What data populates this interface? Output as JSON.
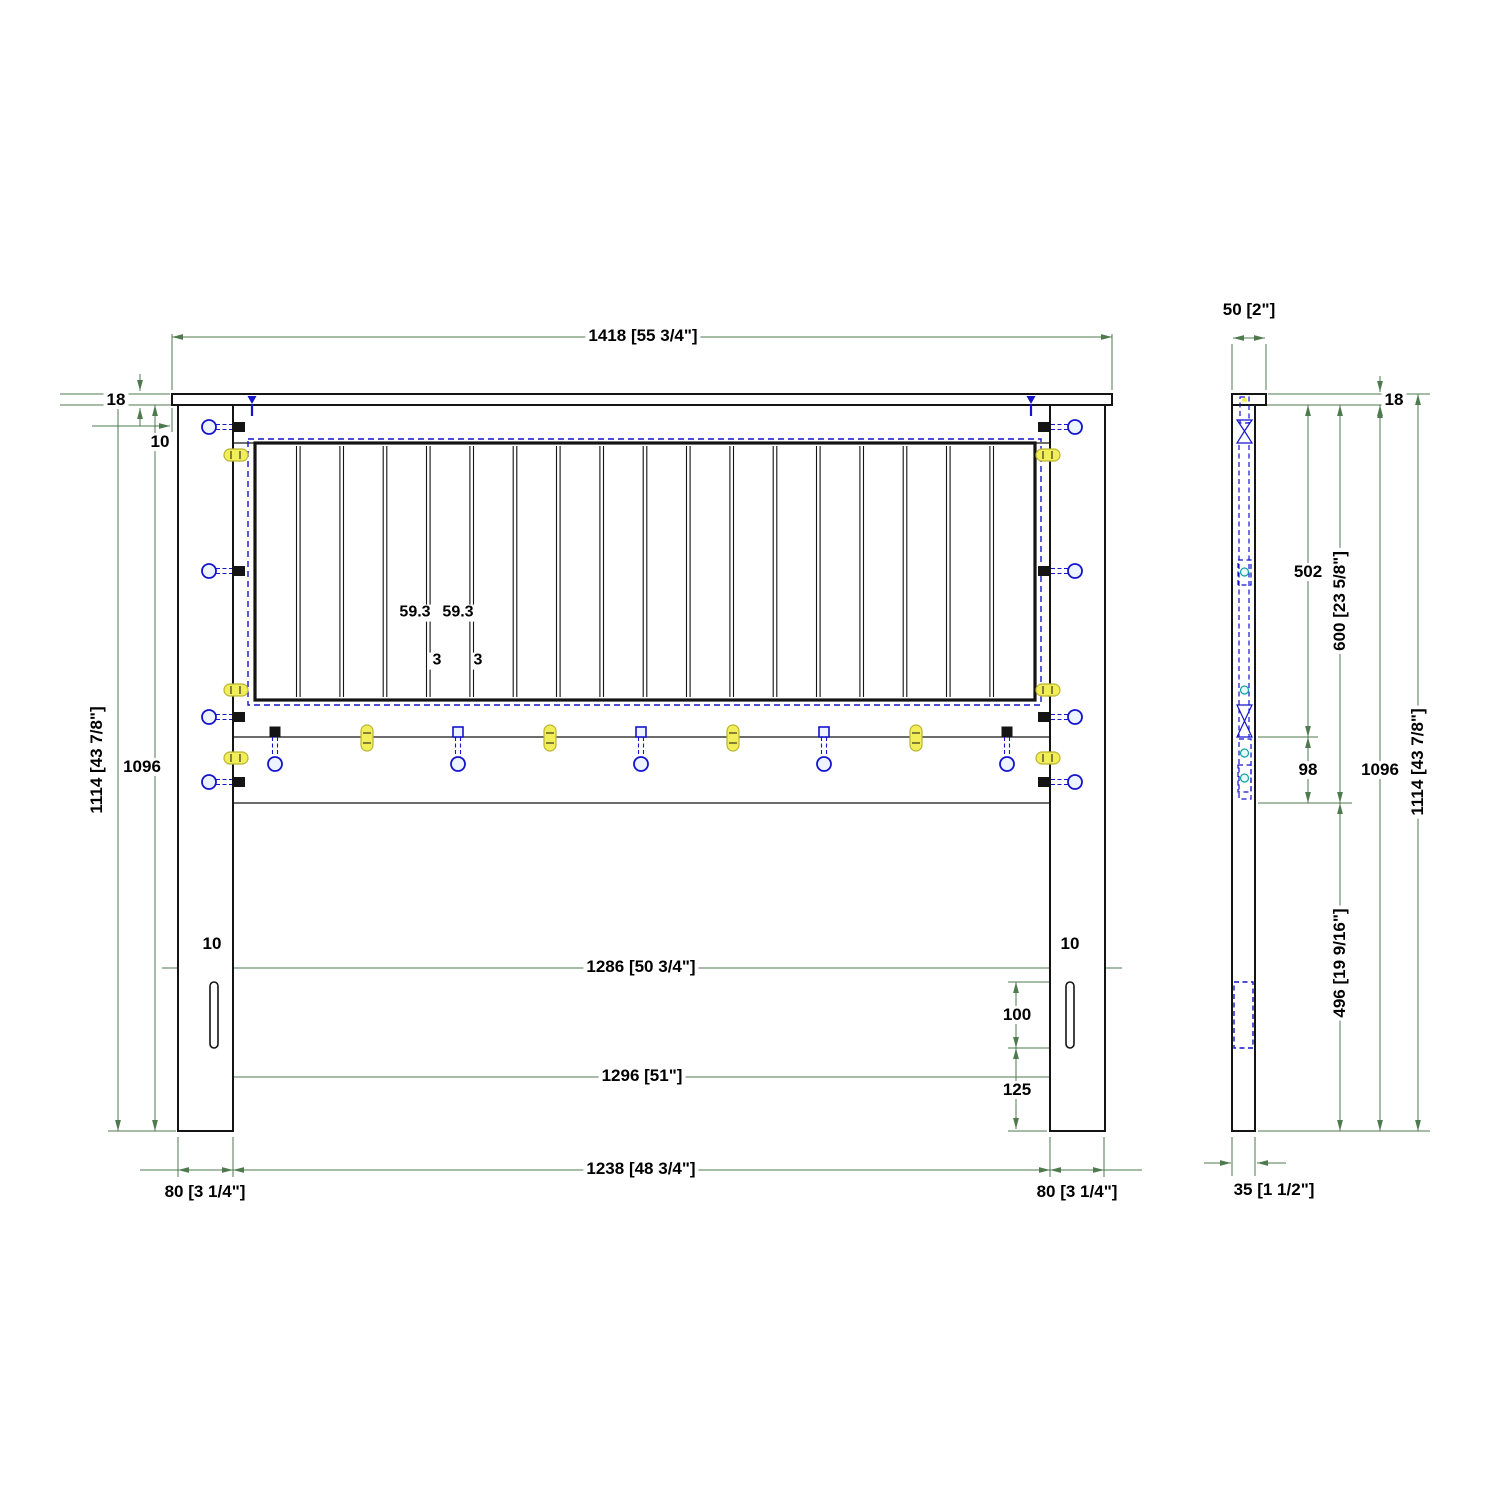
{
  "drawing": {
    "type": "furniture technical drawing - headboard, front and side elevations",
    "front_view": {
      "dims": {
        "width_overall": "1418 [55 3/4\"]",
        "cap_thickness": "18",
        "cap_overhang": "10",
        "height_overall": "1114 [43 7/8\"]",
        "height_post": "1096",
        "slat_pitch_a": "59.3",
        "slat_pitch_b": "59.3",
        "slat_gap_a": "3",
        "slat_gap_b": "3",
        "slot_width_left": "10",
        "slot_width_right": "10",
        "span_slot_inner": "1286 [50 3/4\"]",
        "span_slot_center": "1296 [51\"]",
        "span_posts_inner": "1238 [48 3/4\"]",
        "post_width_left": "80 [3 1/4\"]",
        "post_width_right": "80 [3 1/4\"]",
        "slot_height": "100",
        "slot_offset_bottom": "125"
      },
      "features": {
        "slat_count": 18,
        "post_bolt_count_per_side": 4,
        "post_dowel_count_per_side": 3,
        "rail_bolt_count": 5,
        "rail_dowel_count": 4
      }
    },
    "side_view": {
      "dims": {
        "cap_depth": "50 [2\"]",
        "cap_thickness": "18",
        "top_to_rail": "502",
        "rail_height": "98",
        "top_to_rail_bottom": "600 [23 5/8\"]",
        "height_post": "1096",
        "height_overall": "1114 [43 7/8\"]",
        "rail_bottom_to_floor": "496 [19 9/16\"]",
        "post_depth": "35 [1 1/2\"]"
      }
    },
    "colors": {
      "outline": "#141414",
      "dimension_green": "#4e7a4e",
      "hardware_blue": "#1414cc",
      "dowel_yellow": "#f2ee58",
      "dowel_yellow_border": "#b9b435",
      "background": "#ffffff"
    }
  }
}
